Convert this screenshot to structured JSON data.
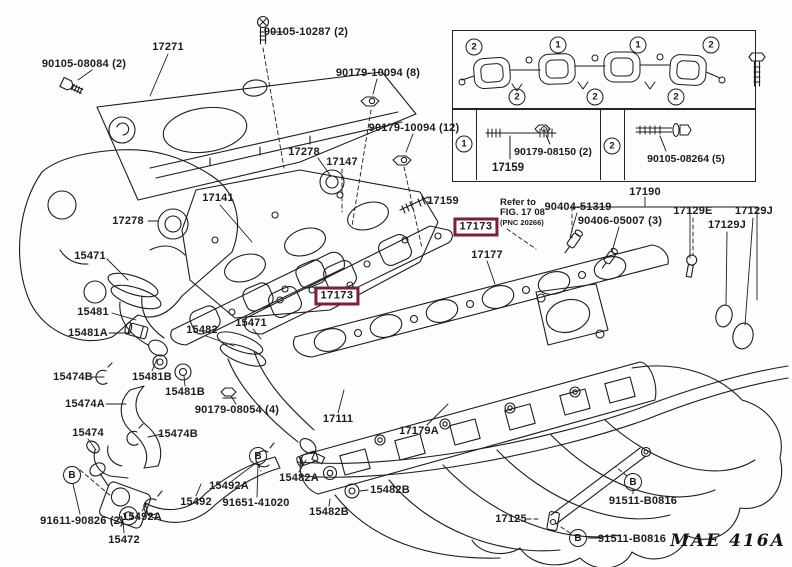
{
  "page": {
    "bg": "#fdfdfb",
    "ink": "#1c1c1c",
    "highlight_color": "#7a1f3e",
    "drawing_code": "MAE 416A",
    "drawing_code_x": 728,
    "drawing_code_y": 541
  },
  "refer_note": {
    "line1": "Refer to",
    "line2": "FIG. 17 08",
    "line3": "(PNC 20266)"
  },
  "highlight_boxes": [
    {
      "text": "17173",
      "x": 476,
      "y": 227
    },
    {
      "text": "17173",
      "x": 337,
      "y": 296
    }
  ],
  "labels": [
    {
      "text": "90105-08084 (2)",
      "x": 84,
      "y": 64
    },
    {
      "text": "17271",
      "x": 168,
      "y": 47
    },
    {
      "text": "90105-10287 (2)",
      "x": 306,
      "y": 32
    },
    {
      "text": "90179-10094 (8)",
      "x": 378,
      "y": 73
    },
    {
      "text": "90179-10094 (12)",
      "x": 414,
      "y": 128
    },
    {
      "text": "17278",
      "x": 304,
      "y": 152
    },
    {
      "text": "17147",
      "x": 342,
      "y": 162
    },
    {
      "text": "17141",
      "x": 218,
      "y": 198
    },
    {
      "text": "17278",
      "x": 128,
      "y": 221
    },
    {
      "text": "15471",
      "x": 90,
      "y": 256
    },
    {
      "text": "17159",
      "x": 443,
      "y": 201
    },
    {
      "text": "17177",
      "x": 487,
      "y": 255
    },
    {
      "text": "15481",
      "x": 93,
      "y": 312
    },
    {
      "text": "15481A",
      "x": 88,
      "y": 333
    },
    {
      "text": "15482",
      "x": 202,
      "y": 330
    },
    {
      "text": "15471",
      "x": 251,
      "y": 323
    },
    {
      "text": "15474B",
      "x": 73,
      "y": 377
    },
    {
      "text": "15481B",
      "x": 152,
      "y": 377
    },
    {
      "text": "15481B",
      "x": 185,
      "y": 392
    },
    {
      "text": "15474A",
      "x": 85,
      "y": 404
    },
    {
      "text": "90179-08054 (4)",
      "x": 237,
      "y": 410
    },
    {
      "text": "15474",
      "x": 88,
      "y": 433
    },
    {
      "text": "15474B",
      "x": 178,
      "y": 434
    },
    {
      "text": "17111",
      "x": 338,
      "y": 419
    },
    {
      "text": "17179A",
      "x": 419,
      "y": 431
    },
    {
      "text": "15492A",
      "x": 142,
      "y": 517
    },
    {
      "text": "15492",
      "x": 196,
      "y": 502
    },
    {
      "text": "15492A",
      "x": 229,
      "y": 486
    },
    {
      "text": "91651-41020",
      "x": 256,
      "y": 503
    },
    {
      "text": "15482A",
      "x": 299,
      "y": 478
    },
    {
      "text": "15482B",
      "x": 390,
      "y": 490
    },
    {
      "text": "15482B",
      "x": 329,
      "y": 512
    },
    {
      "text": "91611-90826 (2)",
      "x": 82,
      "y": 521
    },
    {
      "text": "15472",
      "x": 124,
      "y": 540
    },
    {
      "text": "17125",
      "x": 511,
      "y": 519
    },
    {
      "text": "91511-B0816",
      "x": 643,
      "y": 501
    },
    {
      "text": "91511-B0816",
      "x": 632,
      "y": 539
    },
    {
      "text": "17190",
      "x": 645,
      "y": 192
    },
    {
      "text": "90404-51319",
      "x": 578,
      "y": 207
    },
    {
      "text": "90406-05007 (3)",
      "x": 620,
      "y": 221
    },
    {
      "text": "17129E",
      "x": 693,
      "y": 211
    },
    {
      "text": "17129J",
      "x": 754,
      "y": 211
    },
    {
      "text": "17129J",
      "x": 727,
      "y": 225
    }
  ],
  "circled_numbers": [
    {
      "n": "2",
      "x": 474,
      "y": 47
    },
    {
      "n": "1",
      "x": 558,
      "y": 45
    },
    {
      "n": "1",
      "x": 638,
      "y": 45
    },
    {
      "n": "2",
      "x": 711,
      "y": 45
    },
    {
      "n": "2",
      "x": 517,
      "y": 97
    },
    {
      "n": "2",
      "x": 595,
      "y": 97
    },
    {
      "n": "2",
      "x": 676,
      "y": 97
    },
    {
      "n": "1",
      "x": 464,
      "y": 144
    },
    {
      "n": "2",
      "x": 612,
      "y": 146
    }
  ],
  "circled_letters": [
    {
      "letter": "B",
      "x": 72,
      "y": 475
    },
    {
      "letter": "B",
      "x": 258,
      "y": 456
    },
    {
      "letter": "B",
      "x": 633,
      "y": 482
    },
    {
      "letter": "B",
      "x": 578,
      "y": 538
    }
  ],
  "legend": {
    "stud_part": "17159",
    "nut_part": "90179-08150 (2)",
    "bolt_part": "90105-08264 (5)"
  }
}
